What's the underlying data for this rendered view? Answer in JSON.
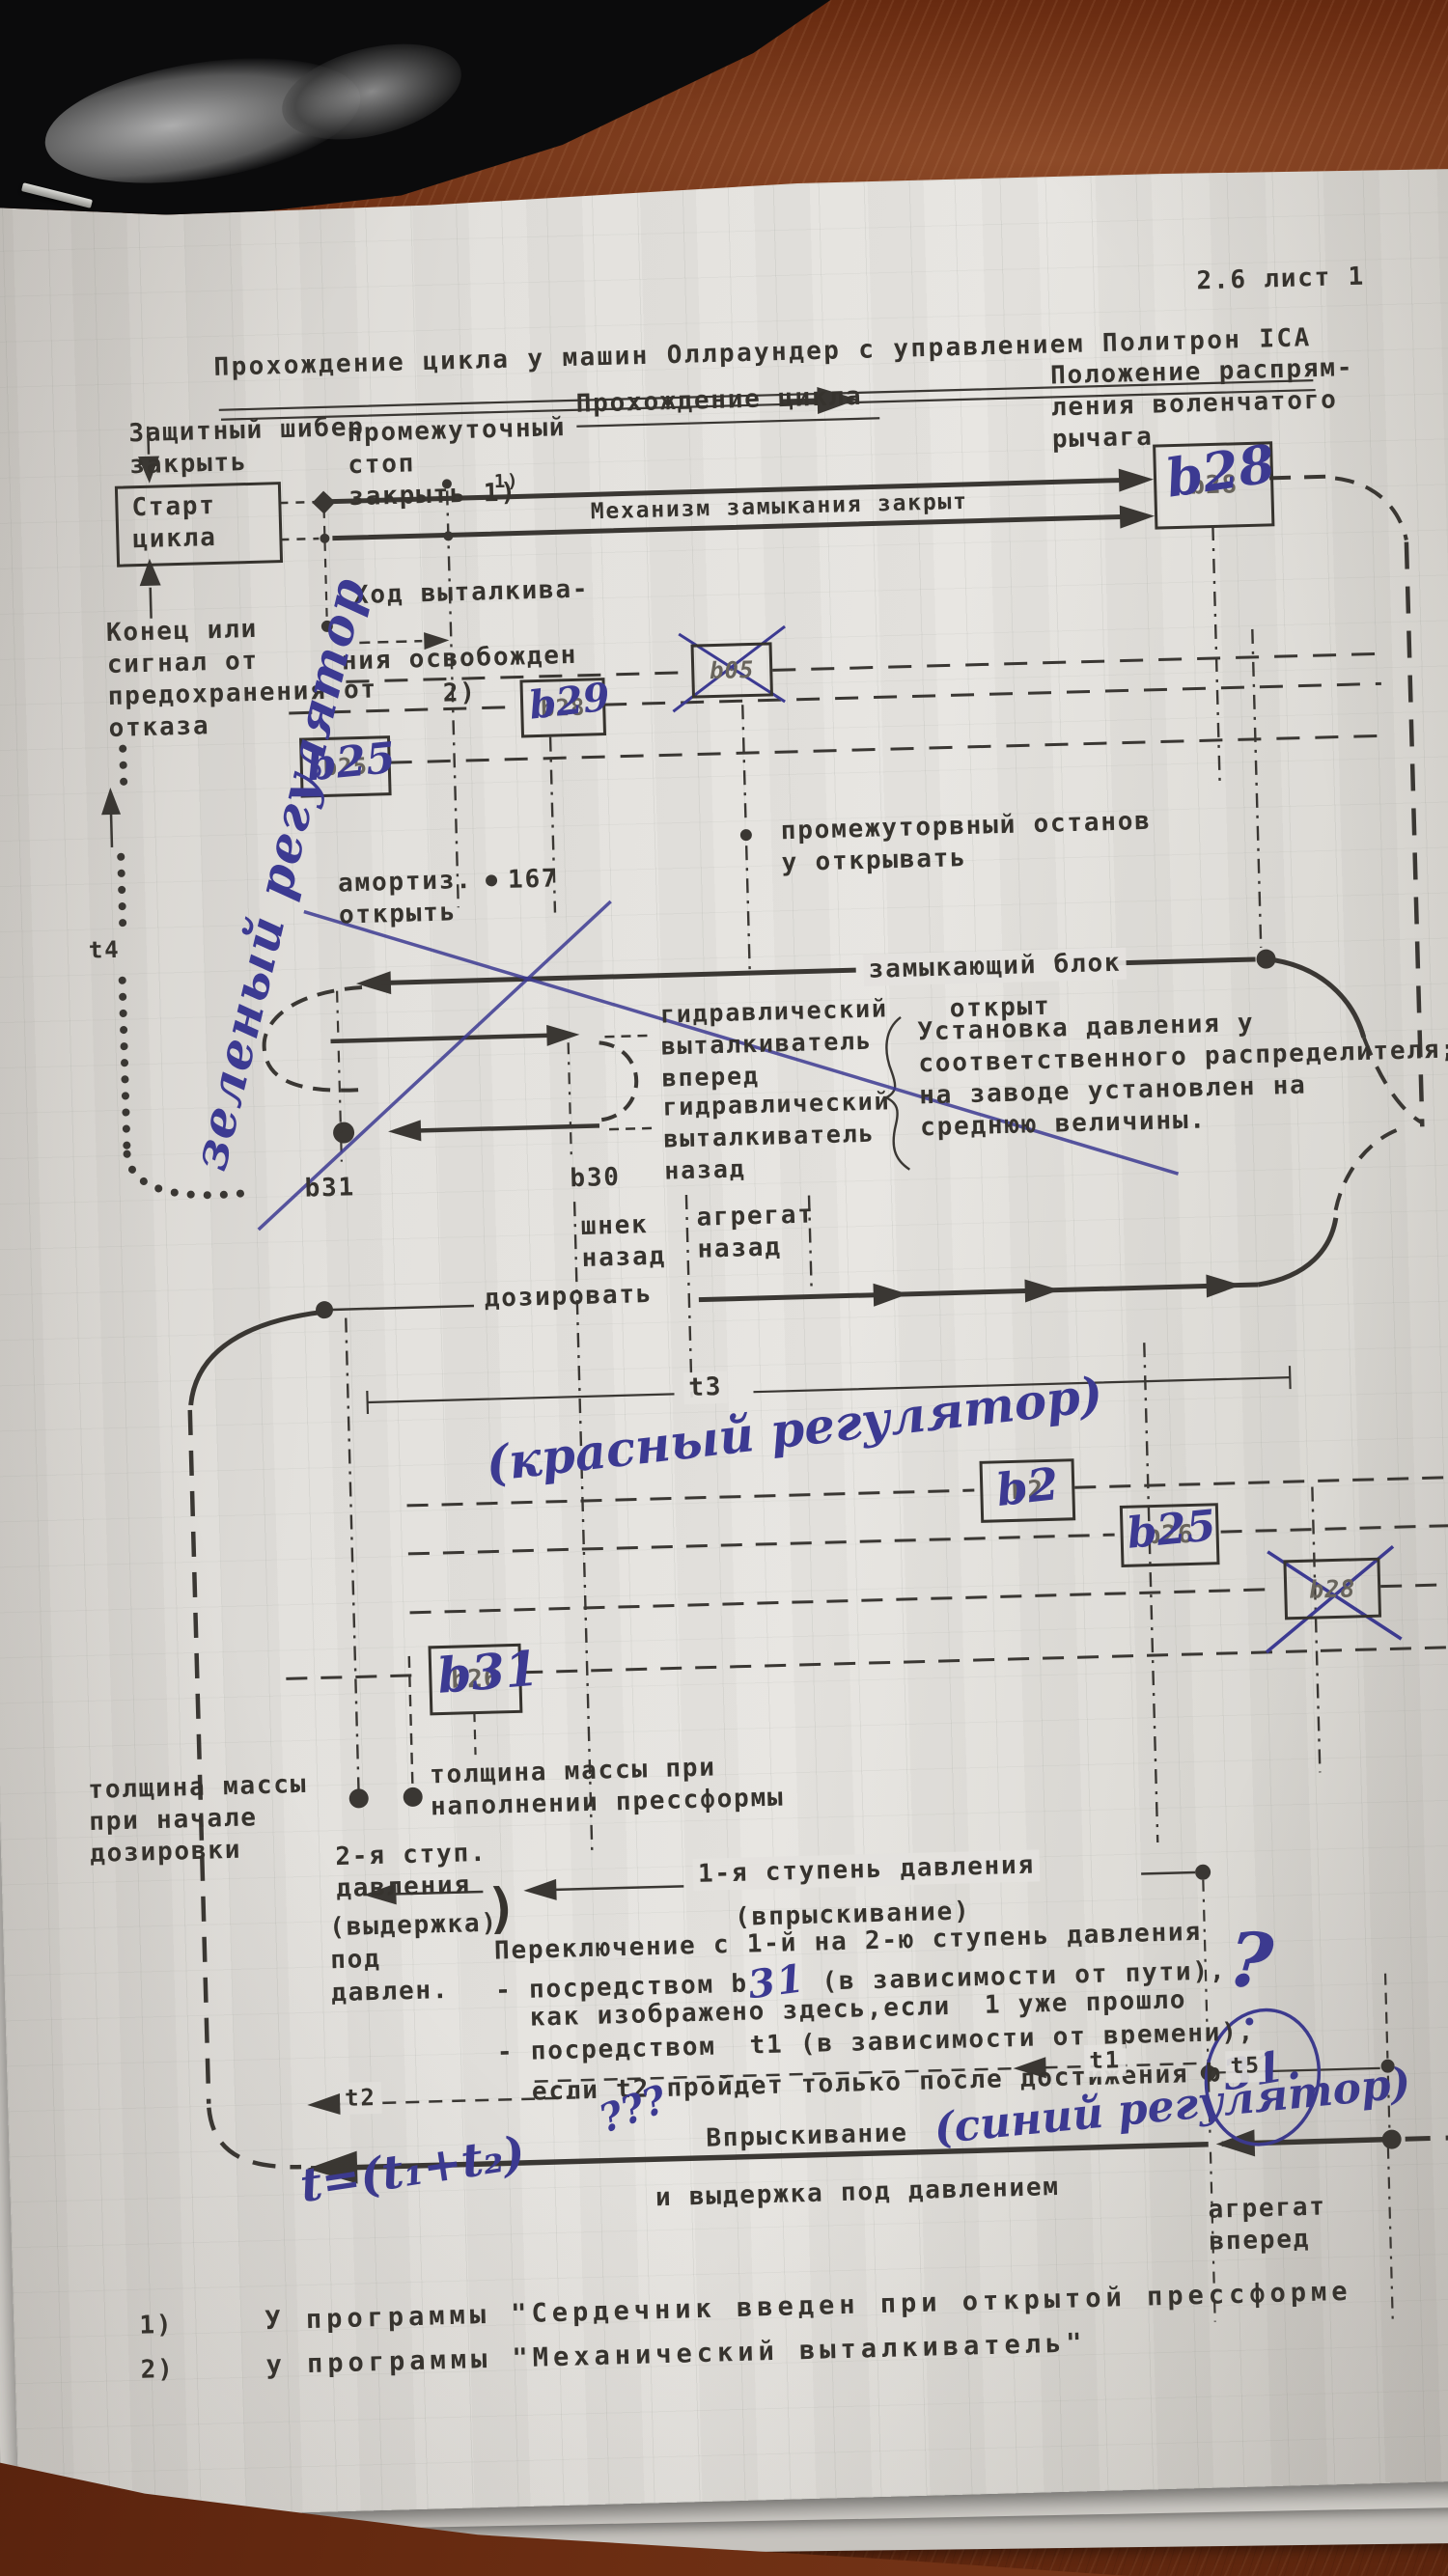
{
  "page": {
    "sheet_no": "2.6  лист 1",
    "title": "Прохождение цикла у машин Оллраундер с управлением Политрон ICA"
  },
  "labels": {
    "flow": "Прохождение цикла",
    "crank": "Положение распрям-\nления воленчатого\nрычага",
    "guard": "Защитный шибер\nзакрыть",
    "interstop": "промежуточный\nстоп\nзакрыть  1)",
    "note1sup": "1)",
    "start_box": "Старт\nцикла",
    "end_signal": "Конец   или\nсигнал от\nпредохранения от\nотказа",
    "mech_closed": "Механизм замыкания закрыт",
    "eject1": "Ход выталкива-",
    "eject2": "ния освобожден",
    "note2": "2)",
    "amort": "амортиз.\nоткрыть",
    "n167": "167",
    "interstop2": "промежуторвный останов\nу открывать",
    "lock1": "замыкающий блок",
    "lock2": "открыт",
    "hydr_fwd": "гидравлический\nвыталкиватель\nвперед",
    "hydr_back": "гидравлический\nвыталкиватель\nназад",
    "b31_label": "b31",
    "b30_label": "b30",
    "setup": "Установка давления у\nсоответственного распределителя;\nна заводе установлен на\nсреднюю величины.",
    "screw_back": "шнек\nназад",
    "unit_back": "агрегат\nназад",
    "dose": "дозировать",
    "t3": "t3",
    "thick_fill": "толщина массы при\nнаполнении прессформы",
    "thick_start": "толщина массы\nпри начале\nдозировки",
    "stage2": "2-я ступ.\nдавления",
    "stage2b": "(выдержка)\nпод\nдавлен.",
    "paren": ")",
    "stage1": "1-я ступень давления",
    "stage1b": "(впрыскивание)",
    "switch1": "Переключение с 1-й на 2-ю ступень давления",
    "switch2a": "- посредством b",
    "switch2b": " (в зависимости от пути),",
    "switch3": "  как изображено здесь,если  1 уже прошло",
    "switch4": "- посредством  t1 (в зависимости от времени),",
    "switch5a": "  если t2 пройдет только после достижения b",
    "t5": "t5",
    "t1": "t1",
    "t2": "t2",
    "t4": "t4",
    "inject": "Впрыскивание",
    "hold": "и выдержка под давлением",
    "unit_fwd": "агрегат\nвперед",
    "fn1n": "1)",
    "fn1": "У программы \"Сердечник введен при открытой прессформе",
    "fn2n": "2)",
    "fn2": "у программы \"Механический выталкиватель\""
  },
  "handwriting": {
    "green_reg": "зеленый регулятор",
    "red_reg": "(красный регулятор)",
    "blue_reg": "(синий регулятор)",
    "formula": "t=(t₁+t₂)",
    "qqq": "???",
    "question": "?",
    "hw31a": "31",
    "hw31b": "31."
  },
  "boxes": {
    "b28_top": {
      "typed": "b28",
      "hand": "b28"
    },
    "b05": {
      "typed": "b05"
    },
    "b29": {
      "typed": "b28",
      "hand": "b29"
    },
    "b25_upper": {
      "typed": "b25",
      "hand": "b25"
    },
    "b2": {
      "typed": "b2",
      "hand": "b2"
    },
    "b25_lower": {
      "typed": "b26",
      "hand": "b25"
    },
    "b28_crossed": {
      "typed": "b28"
    },
    "b31_box": {
      "typed": "b26",
      "hand": "b31"
    }
  },
  "colors": {
    "ink": "#36332e",
    "blue_pen": "#3c3a92",
    "paper": "#e2e0dc",
    "desk_wood": "#6b2d12"
  }
}
